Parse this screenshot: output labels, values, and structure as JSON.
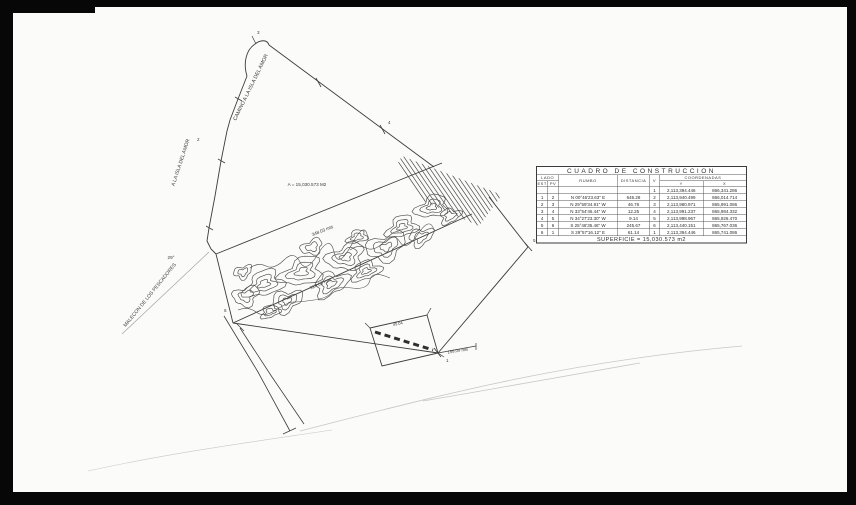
{
  "scan": {
    "page_bg": "#fbfbfa",
    "border_color": "#070707",
    "ink_color": "#3c3c3c",
    "faint_color": "#c7c7c7"
  },
  "drawing_labels": {
    "road_upper": "CAMINO A LA ISLA DEL AMOR",
    "road_lower": "A LA ISLA DEL AMOR",
    "waterfront": "MALECON DE LOS PESCADORES",
    "area_note": "A = 15,030.573 M2",
    "angle_note": "29°",
    "len_band_top": "348.03 mts",
    "len_band_bottom": "318.05 mts",
    "len_corner": "158.04 mts",
    "len_square": "45.04",
    "vertices": [
      "1",
      "2",
      "3",
      "4",
      "5",
      "6"
    ]
  },
  "table": {
    "title": "CUADRO DE CONSTRUCCION",
    "headers": {
      "lado": "LADO",
      "est": "EST",
      "pv": "PV",
      "rumbo": "RUMBO",
      "distancia": "DISTANCIA",
      "v": "V",
      "coordenadas": "COORDENADAS",
      "y": "Y",
      "x": "X"
    },
    "rows": [
      [
        "",
        "",
        "",
        "",
        "1",
        "2,113,394.446",
        "866,341.286"
      ],
      [
        "1",
        "2",
        "N 00°46'23.63\" E",
        "646.28",
        "2",
        "2,113,940.499",
        "866,014.714"
      ],
      [
        "2",
        "3",
        "N 29°59'34.91\" W",
        "46.76",
        "3",
        "2,113,980.971",
        "865,991.086"
      ],
      [
        "3",
        "4",
        "N 33°54'46.44\" W",
        "12.25",
        "4",
        "2,113,991.237",
        "865,984.332"
      ],
      [
        "4",
        "5",
        "N 34°27'23.30\" W",
        "9.14",
        "5",
        "2,113,998.967",
        "865,926.470"
      ],
      [
        "5",
        "6",
        "S 25°46'35.46\" W",
        "245.67",
        "6",
        "2,113,440.151",
        "865,767.036"
      ],
      [
        "6",
        "1",
        "S 29°57'16.12\" E",
        "61.14",
        "1",
        "2,113,394.446",
        "865,741.086"
      ]
    ],
    "superficie": "SUPERFICIE = 15,030.573 m2"
  }
}
